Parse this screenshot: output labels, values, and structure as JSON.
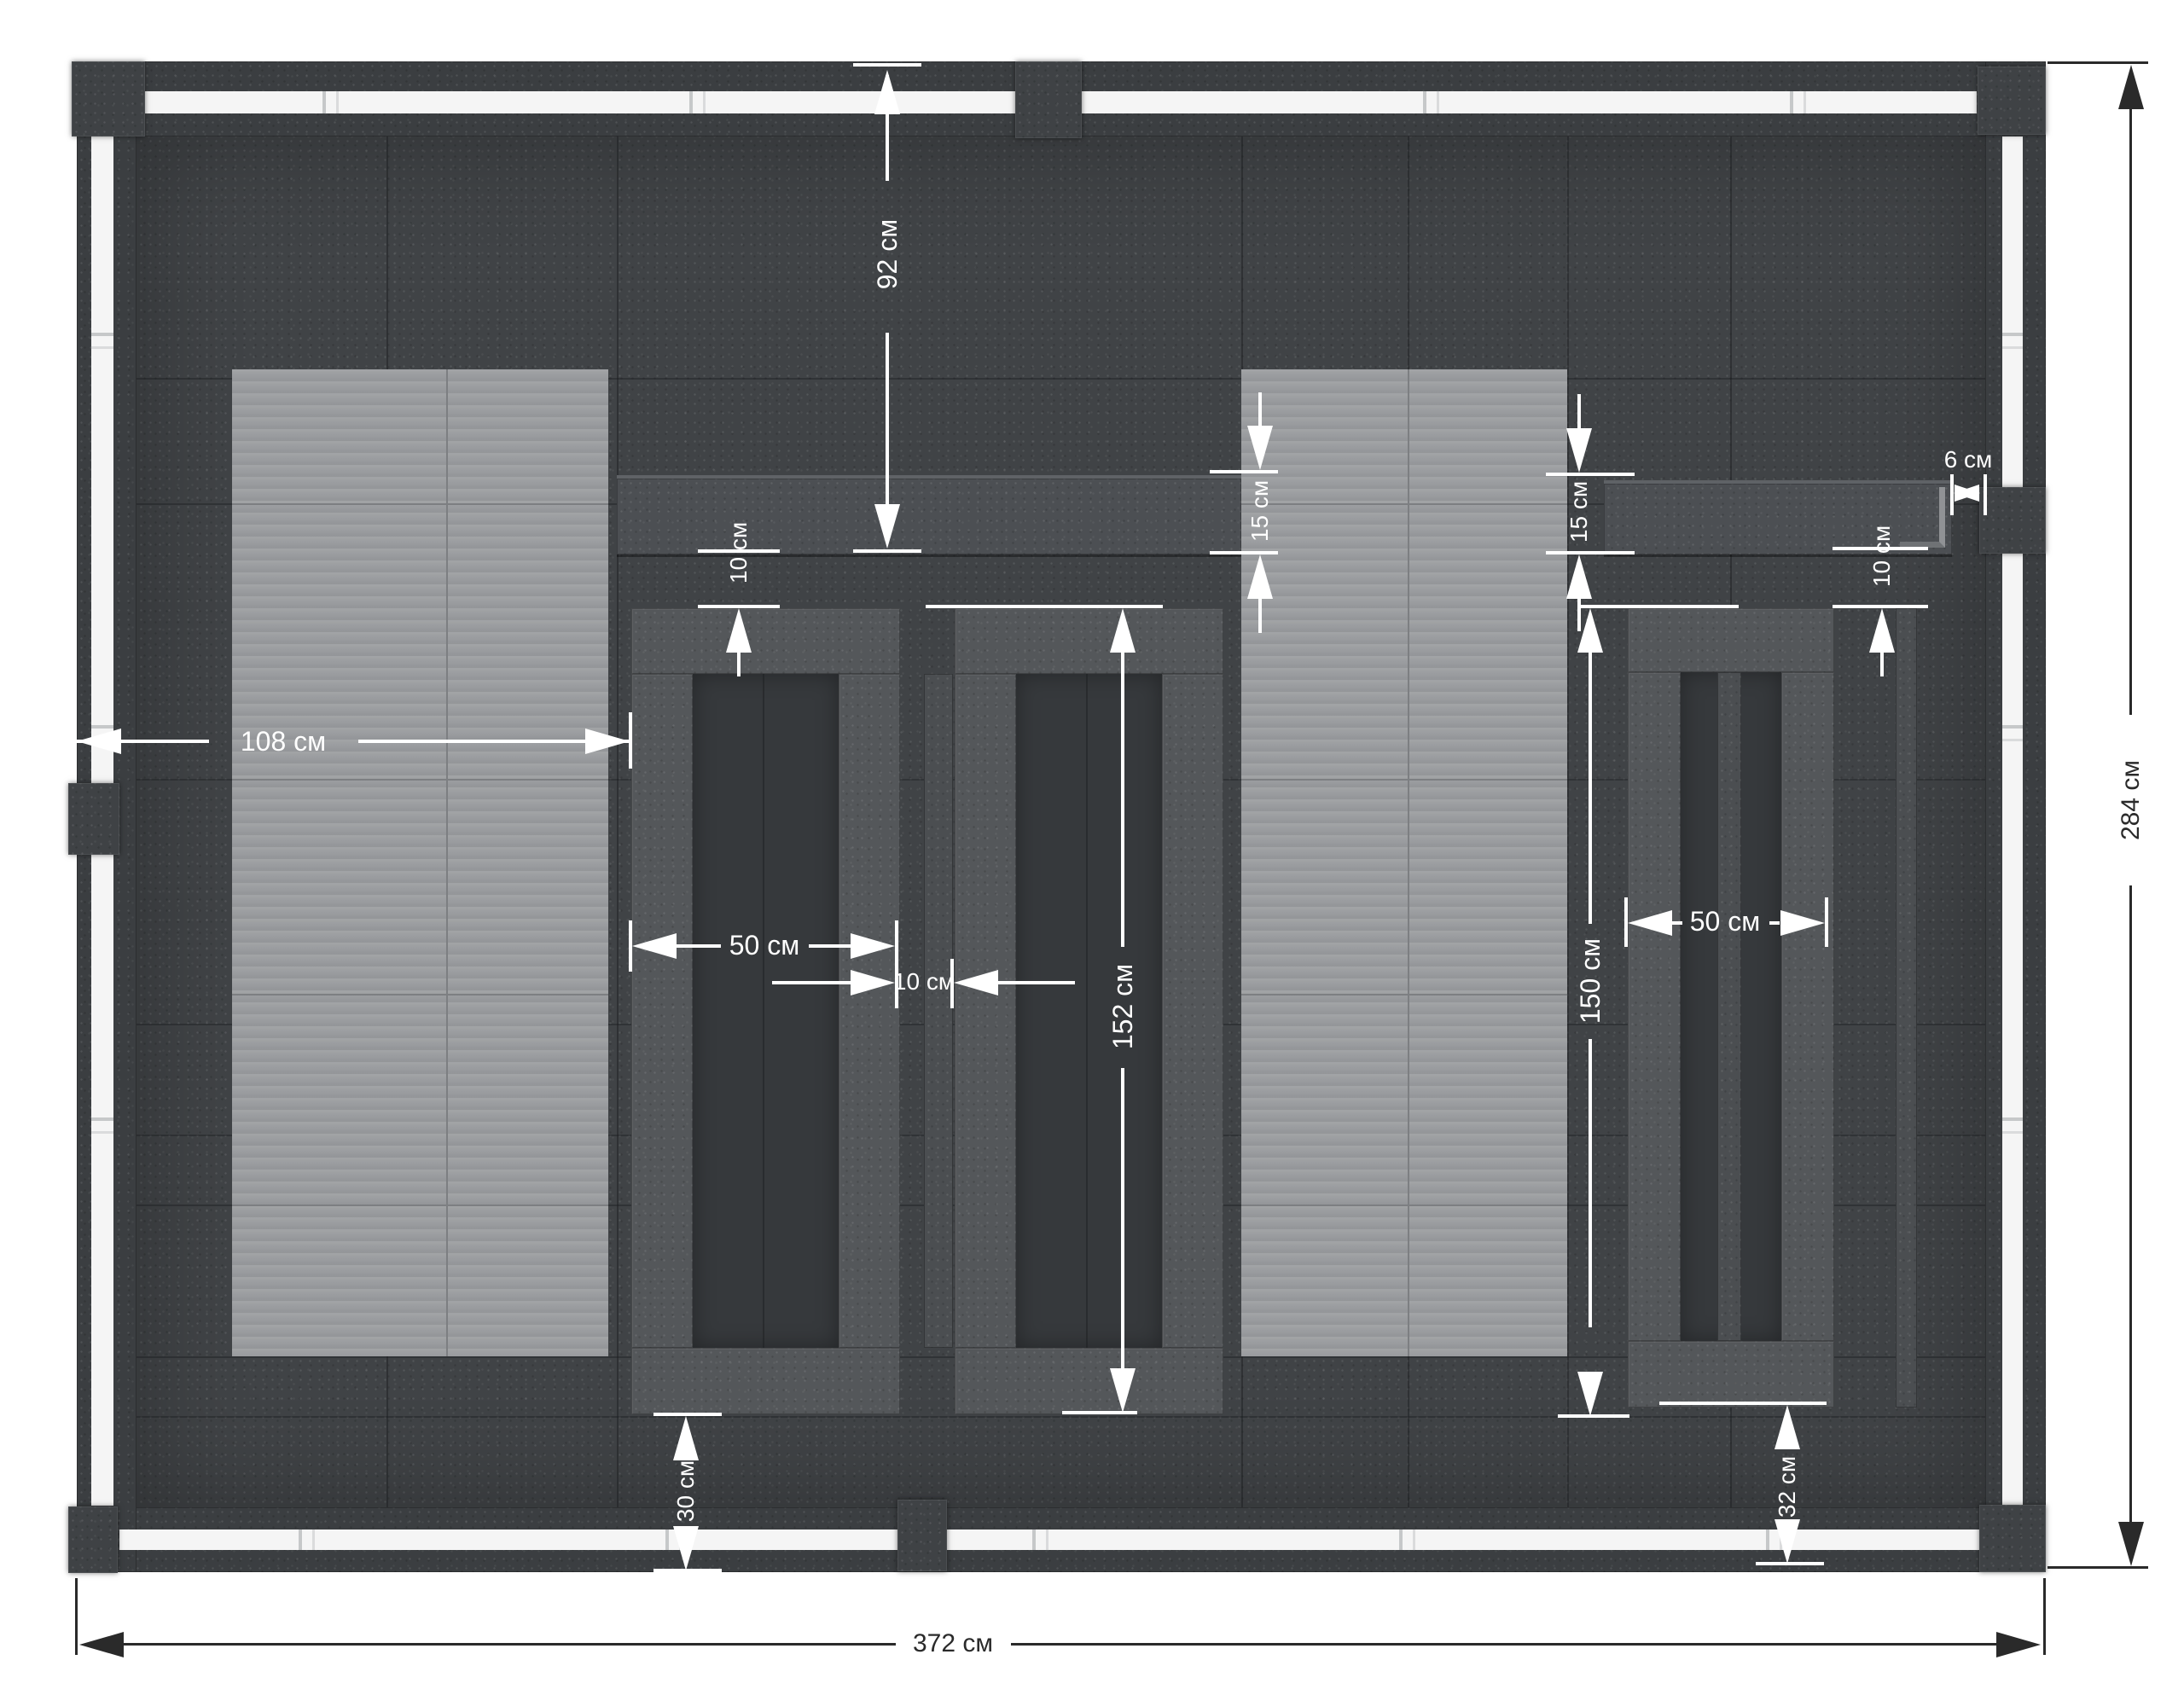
{
  "drawing": {
    "kind": "top-view construction plan",
    "unit": "см",
    "colors": {
      "background": "#ffffff",
      "floor": "#404346",
      "wall": "#3b3e41",
      "light_panel": "#9b9da0",
      "beam": "#4c4f53",
      "bench_slat": "#54575a",
      "rail_track": "#f5f5f5",
      "dim_light": "#ffffff",
      "dim_dark": "#2a2a2a"
    },
    "dimensions": {
      "back_clearance": "92 см",
      "beam_depth_middle": "15 см",
      "beam_depth_right": "15 см",
      "beam_end_gap": "6 см",
      "beam_bench_gap_middle": "10 см",
      "beam_bench_gap_right": "10 см",
      "left_bay_width": "108 см",
      "bench_width_middle": "50 см",
      "bench_gap": "10 см",
      "bench_length_middle": "152 см",
      "bench_length_right": "150 см",
      "bench_width_right": "50 см",
      "bottom_clearance_left": "30 см",
      "bottom_clearance_right": "32 см",
      "overall_width": "372 см",
      "overall_depth": "284 см"
    }
  }
}
